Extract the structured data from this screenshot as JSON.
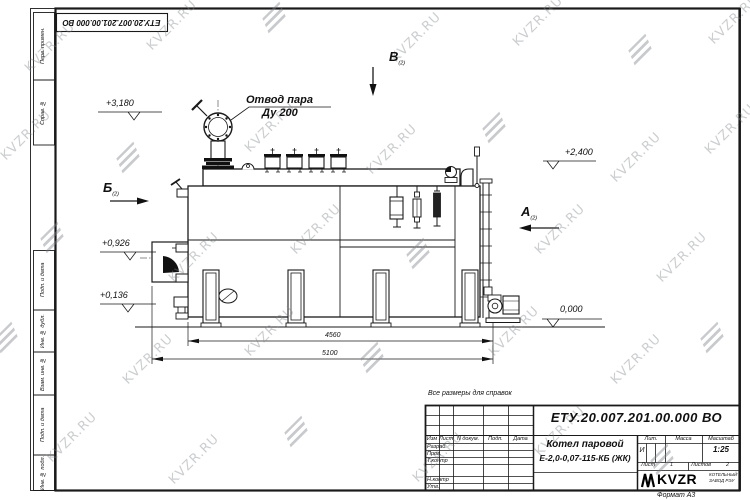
{
  "sheet": {
    "designation": "ЕТУ.20.007.201.00.000 ВО",
    "format_note": "Формат А3",
    "reference_note": "Все размеры для справок"
  },
  "frame_columns": {
    "col1": "Перв. примен.",
    "col2": "Справ. №",
    "col3": "Подп. и дата",
    "col4": "Инв. № дубл.",
    "col5": "Взам. инв. №",
    "col6": "Подп. и дата",
    "col7": "Инв. № подл."
  },
  "annotations": {
    "steam_outlet": {
      "line1": "Отвод пара",
      "line2": "Ду 200"
    },
    "elev_3180": "+3,180",
    "elev_2400": "+2,400",
    "elev_0926": "+0,926",
    "elev_0136": "+0,136",
    "elev_0000": "0,000",
    "view_b": {
      "label": "Б",
      "note": "(2)"
    },
    "view_v": {
      "label": "В",
      "note": "(2)"
    },
    "view_a": {
      "label": "А",
      "note": "(2)"
    },
    "dim_inner": "4560",
    "dim_outer": "5100"
  },
  "title_block": {
    "designation": "ЕТУ.20.007.201.00.000 ВО",
    "product_line1": "Котел паровой",
    "product_line2": "Е-2,0-0,07-115-КБ (ЖК)",
    "rev_header": {
      "izm": "Изм",
      "list": "Лист",
      "doc": "N докум.",
      "podp": "Подп.",
      "data": "Дата"
    },
    "sig": {
      "razrab": "Разраб.",
      "prov": "Пров.",
      "tkontr": "Т.контр",
      "nkontr": "Н.контр",
      "utv": "Утв."
    },
    "lit_label": "Лит.",
    "lit_value": "И",
    "mass_label": "Масса",
    "scale_label": "Масштаб",
    "scale_value": "1:25",
    "sheet_label": "Лист",
    "sheet_value": "1",
    "sheets_label": "Листов",
    "sheets_value": "2",
    "company": {
      "name": "KVZR",
      "tagline1": "КОТЕЛЬНЫЙ",
      "tagline2": "ЗАВОД РЭУ"
    }
  },
  "watermark": {
    "text": "KVZR.RU"
  }
}
